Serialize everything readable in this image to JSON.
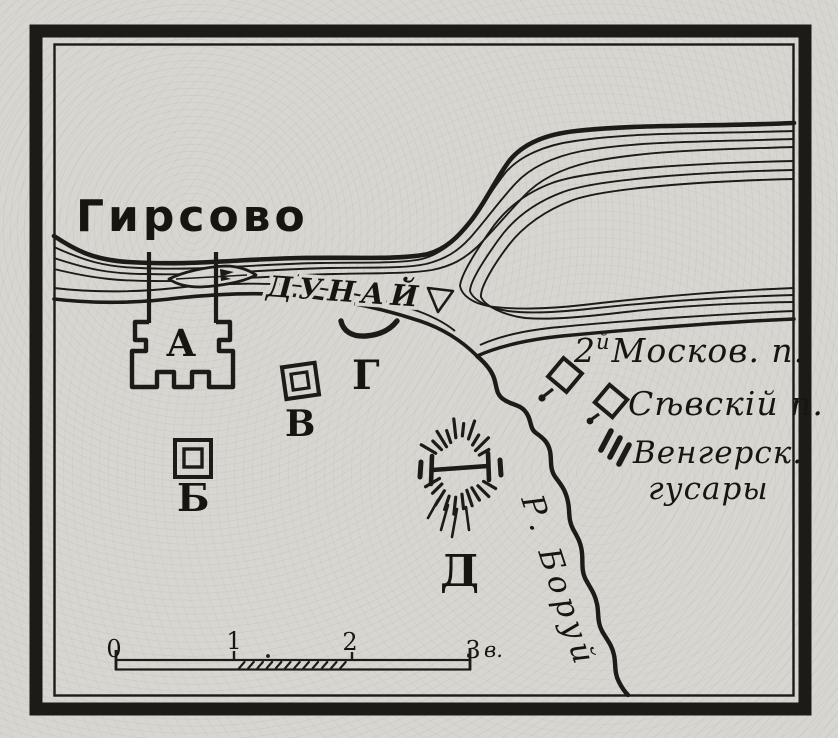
{
  "map": {
    "town": "Гирсово",
    "river": "ДУНАЙ",
    "tributary": "Р. Боруй",
    "markers": {
      "a": "А",
      "b": "Б",
      "v": "В",
      "g": "Г",
      "d": "Д"
    },
    "units": {
      "moskov": {
        "num": "2",
        "sup": "й",
        "name": "Москов. п."
      },
      "sevsky": {
        "name": "Сѣвскій п."
      },
      "hussars": {
        "line1": "Венгерск.",
        "line2": "гусары"
      }
    },
    "scale": {
      "t0": "0",
      "t1": "1",
      "t2": "2",
      "t3": "3",
      "unit": "в."
    },
    "colors": {
      "paper": "#d8d6d1",
      "ink": "#1d1b17"
    }
  }
}
